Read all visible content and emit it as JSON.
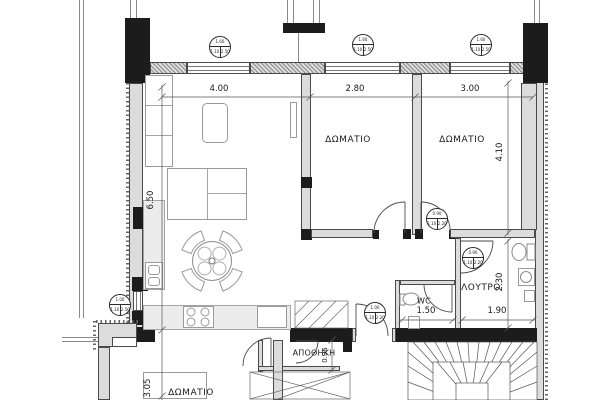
{
  "drawing": {
    "language": "Greek",
    "rooms": {
      "bedroom1": "ΔΩΜΑΤΙΟ",
      "bedroom2": "ΔΩΜΑΤΙΟ",
      "bathroom": "ΛΟΥΤΡΟ",
      "wc": "WC",
      "storage": "ΑΠΟΘΗΚΗ",
      "lower_bedroom": "ΔΩΜΑΤΙΟ"
    },
    "dimensions": {
      "living_width": "4.00",
      "bedroom1_width": "2.80",
      "bedroom2_width": "3.00",
      "living_depth": "6.50",
      "bedroom2_depth": "4.10",
      "bathroom_depth": "2.30",
      "bathroom_width": "1.90",
      "wc_width": "1.50",
      "lower_bedroom_depth": "3.05",
      "storage_width": "0.95"
    },
    "tags": {
      "window_living": {
        "w": "1.60",
        "h": "1.10",
        "s": "2.50"
      },
      "window_bedroom1": {
        "w": "1.60",
        "h": "1.10",
        "s": "2.50"
      },
      "window_bedroom2": {
        "w": "1.60",
        "h": "1.10",
        "s": "2.50"
      },
      "window_kitchen": {
        "w": "1.00",
        "h": "1.10",
        "s": "2.50"
      },
      "door_bedroom2": {
        "w": "0.90",
        "h": "1.10",
        "s": "2.20"
      },
      "door_bathroom": {
        "w": "0.90",
        "h": "1.10",
        "s": "2.20"
      },
      "door_entrance": {
        "w": "1.00",
        "h": "1.10",
        "s": "2.20"
      }
    },
    "colors": {
      "wall_black": "#1c1c1c",
      "wall_gray": "#dcdcdc",
      "line": "#555555",
      "background": "#ffffff"
    }
  }
}
